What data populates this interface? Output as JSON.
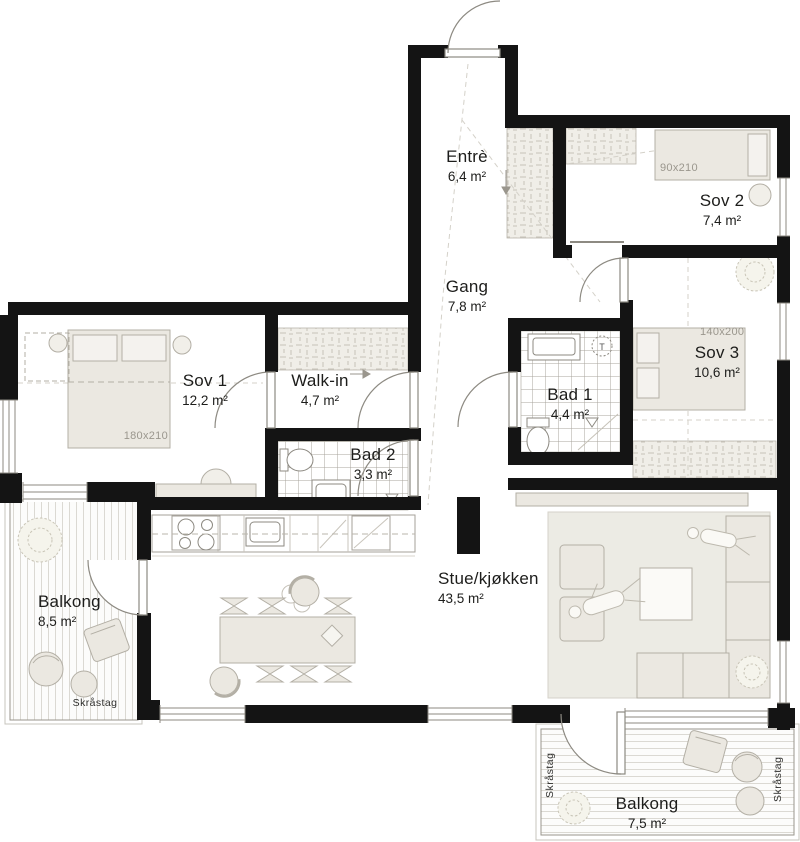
{
  "rooms": {
    "entre": {
      "name": "Entrè",
      "area": "6,4 m²"
    },
    "sov2": {
      "name": "Sov 2",
      "area": "7,4 m²"
    },
    "gang": {
      "name": "Gang",
      "area": "7,8 m²"
    },
    "sov3": {
      "name": "Sov 3",
      "area": "10,6 m²"
    },
    "sov1": {
      "name": "Sov 1",
      "area": "12,2 m²"
    },
    "walkin": {
      "name": "Walk-in",
      "area": "4,7 m²"
    },
    "bad1": {
      "name": "Bad 1",
      "area": "4,4 m²"
    },
    "bad2": {
      "name": "Bad 2",
      "area": "3,3 m²"
    },
    "balkong1": {
      "name": "Balkong",
      "area": "8,5 m²"
    },
    "stue": {
      "name": "Stue/kjøkken",
      "area": "43,5 m²"
    },
    "balkong2": {
      "name": "Balkong",
      "area": "7,5 m²"
    }
  },
  "bed_dimensions": {
    "sov1": "180x210",
    "sov2": "90x210",
    "sov3": "140x200"
  },
  "annotations": {
    "skrastag_balkong1": "Skråstag",
    "skrastag_balkong2_left": "Skråstag",
    "skrastag_balkong2_right": "Skråstag",
    "washer_symbol": "T"
  },
  "colors": {
    "wall": "#141414",
    "furniture_fill": "#ebe8e1",
    "furniture_stroke": "#b3afa5",
    "tile_line": "#a8a49c",
    "deck_line": "#dbd9d3",
    "dimension_text": "#9a968d"
  }
}
